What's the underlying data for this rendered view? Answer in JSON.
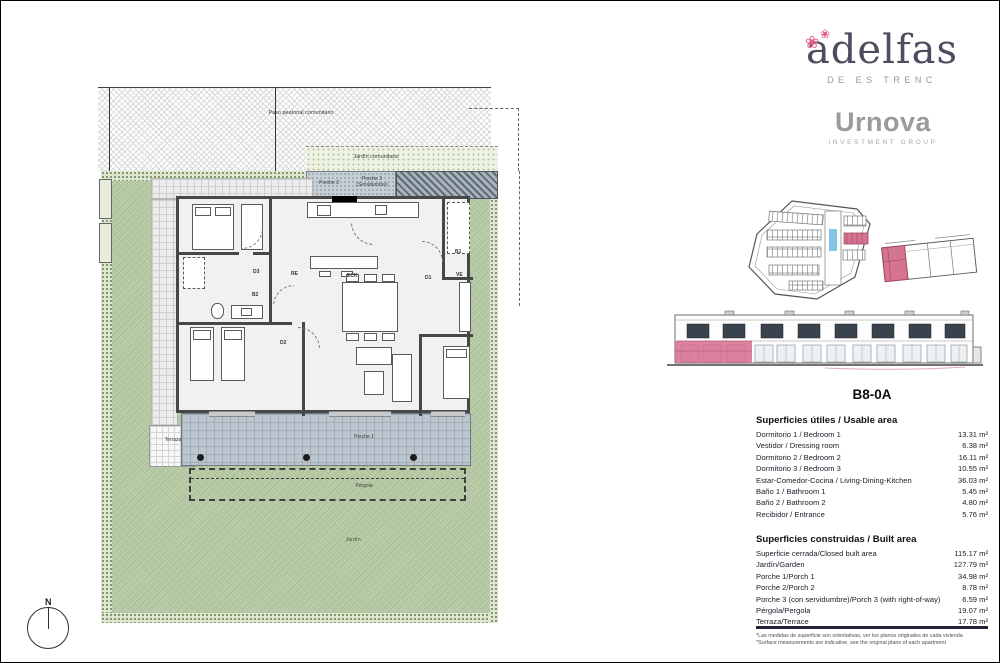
{
  "branding": {
    "adelfas_wordmark": "adelfas",
    "adelfas_sub": "DE ES TRENC",
    "flower_icon": "❀",
    "urnova_wordmark": "Urnova",
    "urnova_sub": "INVESTMENT GROUP",
    "accent_pink": "#d4748f",
    "pool_blue": "#85c4e6",
    "logo_navy": "#4d4d62",
    "logo_gray": "#9b9b9b"
  },
  "unit": {
    "title": "B8-0A"
  },
  "plan": {
    "paso_label": "Paso peatonal comunitario",
    "jardin_comunitario_label": "Jardín comunitario",
    "porche2_label": "Porche 2",
    "porche3_label": "Porche 3 (Servidumbre)",
    "terraza_label": "Terraza",
    "porche1_label": "Porche 1",
    "pergola_label": "Pérgola",
    "jardin_label": "Jardín",
    "north_label": "N",
    "rooms": {
      "d1": "D1",
      "d2": "D2",
      "d3": "D3",
      "b1": "B1",
      "b2": "B2",
      "re": "RE",
      "ve": "VE",
      "eck": "ECK"
    },
    "garden_green": "#b2c7a0"
  },
  "usable_table": {
    "title": "Superficies útiles / Usable area",
    "rows": [
      {
        "label": "Dormitorio 1 / Bedroom 1",
        "value": "13.31 m²"
      },
      {
        "label": "Vestidor / Dressing room",
        "value": "6.38 m²"
      },
      {
        "label": "Dormitorio 2 / Bedroom 2",
        "value": "16.11 m²"
      },
      {
        "label": "Dormitorio 3 / Bedroom 3",
        "value": "10.55 m²"
      },
      {
        "label": "Estar-Comedor-Cocina / Living-Dining-Kitchen",
        "value": "36.03 m²"
      },
      {
        "label": "Baño 1 / Bathroom 1",
        "value": "5.45 m²"
      },
      {
        "label": "Baño 2 / Bathroom 2",
        "value": "4.80 m²"
      },
      {
        "label": "Recibidor / Entrance",
        "value": "5.76 m²"
      }
    ]
  },
  "built_table": {
    "title": "Superficies construidas / Built area",
    "rows": [
      {
        "label": "Superficie cerrada/Closed built area",
        "value": "115.17 m²"
      },
      {
        "label": "Jardín/Garden",
        "value": "127.79 m²"
      },
      {
        "label": "Porche 1/Porch 1",
        "value": "34.98 m²"
      },
      {
        "label": "Porche 2/Porch 2",
        "value": "8.78 m²"
      },
      {
        "label": "Porche 3 (con servidumbre)/Porch 3 (with right-of-way)",
        "value": "6.59 m²"
      },
      {
        "label": "Pérgola/Pergola",
        "value": "19.07 m²"
      },
      {
        "label": "Terraza/Terrace",
        "value": "17.78 m²"
      }
    ]
  },
  "footnotes": [
    "*Las medidas de superficie son orientativas, ver los planos originales de cada vivienda",
    "*Surface measurements are indicative, see the original plans of each apartment"
  ]
}
